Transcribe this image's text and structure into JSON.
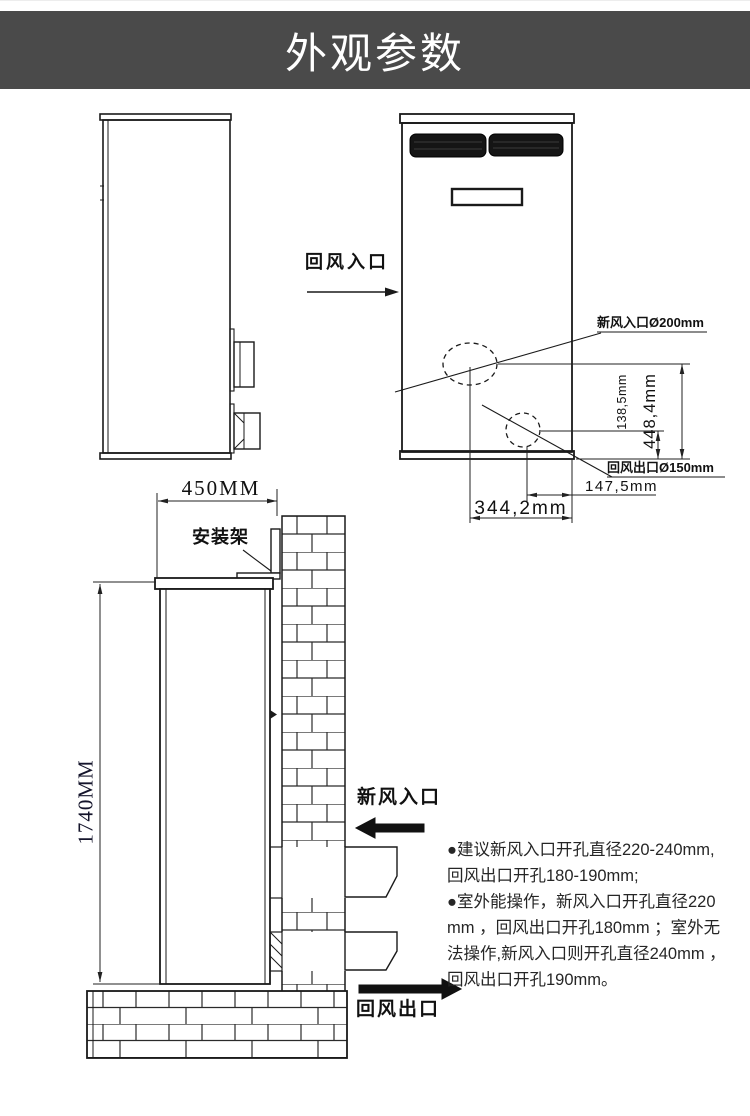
{
  "header": {
    "title": "外观参数"
  },
  "colors": {
    "header_bg": "#4a4a4a",
    "header_fg": "#ffffff",
    "line": "#1a1a1a"
  },
  "side_view": {
    "return_air_inlet_label": "回风入口"
  },
  "front_view": {
    "fresh_air_hole_label": "新风入口Ø200mm",
    "return_air_hole_label": "回风出口Ø150mm",
    "dim_height_upper": "138,5mm",
    "dim_height_total": "448,4mm",
    "dim_offset_right": "147,5mm",
    "dim_offset_bottom": "344,2mm"
  },
  "install_view": {
    "dim_depth": "450MM",
    "dim_height": "1740MM",
    "bracket_label": "安装架",
    "fresh_air_inlet_label": "新风入口",
    "return_air_outlet_label": "回风出口"
  },
  "notes": {
    "lines": [
      "●建议新风入口开孔直径220-240mm,",
      "回风出口开孔180-190mm;",
      "●室外能操作，新风入口开孔直径220",
      "mm ，回风出口开孔180mm ；室外无",
      "法操作,新风入口则开孔直径240mm ，",
      "回风出口开孔190mm。"
    ]
  }
}
